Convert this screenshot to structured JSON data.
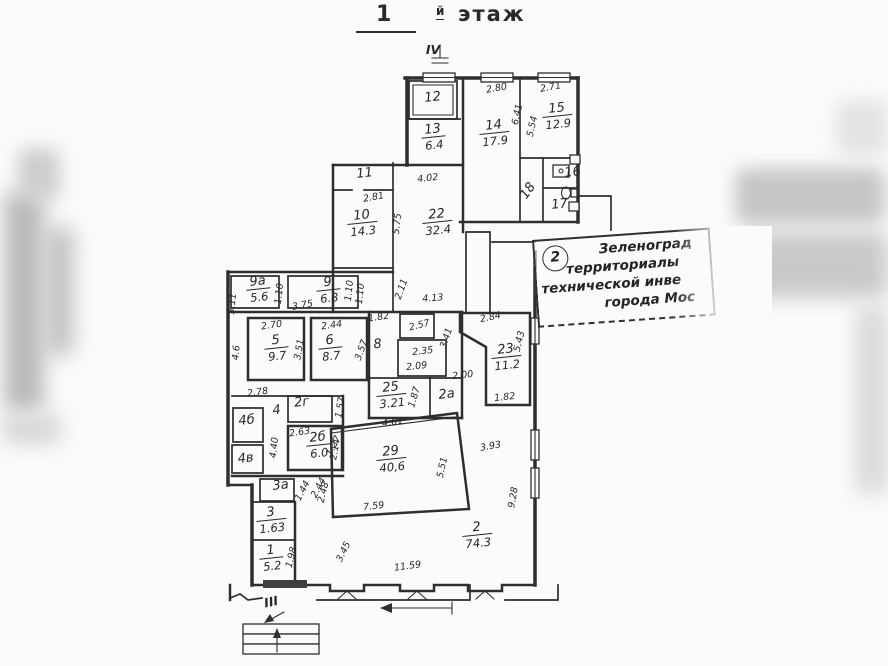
{
  "title": {
    "floor": "1",
    "suffix": "й",
    "word": "этаж"
  },
  "stamp": {
    "number": "2",
    "lines": [
      "Зеленоград",
      "территориалы",
      "технической инве",
      "города Мос"
    ]
  },
  "plan": {
    "rooms": [
      {
        "num": "12",
        "x": 433,
        "y": 101
      },
      {
        "num": "13",
        "area": "6.4",
        "x": 433,
        "y": 133
      },
      {
        "num": "14",
        "area": "17.9",
        "x": 494,
        "y": 129
      },
      {
        "num": "15",
        "area": "12.9",
        "x": 557,
        "y": 112
      },
      {
        "num": "16",
        "x": 573,
        "y": 176,
        "fs": 10
      },
      {
        "num": "17",
        "x": 560,
        "y": 208,
        "fs": 11
      },
      {
        "num": "18",
        "x": 531,
        "y": 193,
        "rot": -55,
        "fs": 11
      },
      {
        "num": "11",
        "x": 365,
        "y": 177
      },
      {
        "num": "10",
        "area": "14.3",
        "x": 362,
        "y": 219
      },
      {
        "num": "22",
        "area": "32.4",
        "x": 437,
        "y": 218
      },
      {
        "num": "9а",
        "area": "5.6",
        "x": 258,
        "y": 285
      },
      {
        "num": "9",
        "area": "6.8",
        "x": 328,
        "y": 286
      },
      {
        "num": "5",
        "area": "9.7",
        "x": 276,
        "y": 344
      },
      {
        "num": "6",
        "area": "8.7",
        "x": 330,
        "y": 344
      },
      {
        "num": "8",
        "x": 378,
        "y": 348
      },
      {
        "num": "23",
        "area": "11.2",
        "x": 506,
        "y": 353
      },
      {
        "num": "25",
        "area": "3.21",
        "x": 391,
        "y": 391
      },
      {
        "num": "2а",
        "x": 447,
        "y": 398,
        "fs": 11
      },
      {
        "num": "2г",
        "x": 302,
        "y": 406,
        "fs": 11
      },
      {
        "num": "2б",
        "area": "6.0",
        "x": 318,
        "y": 441
      },
      {
        "num": "4",
        "x": 277,
        "y": 414,
        "fs": 11
      },
      {
        "num": "4б",
        "x": 247,
        "y": 424,
        "fs": 11
      },
      {
        "num": "4в",
        "x": 246,
        "y": 462,
        "fs": 11
      },
      {
        "num": "3а",
        "x": 281,
        "y": 489,
        "fs": 11
      },
      {
        "num": "3",
        "area": "1.63",
        "x": 271,
        "y": 516
      },
      {
        "num": "1",
        "area": "5.2",
        "x": 271,
        "y": 554
      },
      {
        "num": "29",
        "area": "40,6",
        "x": 391,
        "y": 455
      },
      {
        "num": "2",
        "area": "74.3",
        "x": 477,
        "y": 531
      }
    ],
    "dimensions": [
      {
        "t": "2.80",
        "x": 497,
        "y": 91,
        "rot": -10
      },
      {
        "t": "2.71",
        "x": 551,
        "y": 90,
        "rot": -10
      },
      {
        "t": "6.41",
        "x": 520,
        "y": 115,
        "rot": -78
      },
      {
        "t": "5.54",
        "x": 535,
        "y": 127,
        "rot": -78
      },
      {
        "t": "4.02",
        "x": 428,
        "y": 181,
        "rot": -6
      },
      {
        "t": "2.81",
        "x": 374,
        "y": 200,
        "rot": -10
      },
      {
        "t": "5.75",
        "x": 400,
        "y": 224,
        "rot": -84
      },
      {
        "t": "1.10",
        "x": 352,
        "y": 291,
        "rot": -84
      },
      {
        "t": "2.11",
        "x": 404,
        "y": 290,
        "rot": -70
      },
      {
        "t": "4.13",
        "x": 433,
        "y": 301,
        "rot": -4
      },
      {
        "t": "3.11",
        "x": 235,
        "y": 304,
        "rot": -84
      },
      {
        "t": "1.10",
        "x": 282,
        "y": 294,
        "rot": -84
      },
      {
        "t": "3.75",
        "x": 303,
        "y": 308,
        "rot": -10
      },
      {
        "t": "1.10",
        "x": 363,
        "y": 294,
        "rot": -84
      },
      {
        "t": "2.70",
        "x": 272,
        "y": 328,
        "rot": -8
      },
      {
        "t": "3.51",
        "x": 302,
        "y": 350,
        "rot": -80
      },
      {
        "t": "2.44",
        "x": 332,
        "y": 328,
        "rot": -8
      },
      {
        "t": "3.57",
        "x": 364,
        "y": 351,
        "rot": -70
      },
      {
        "t": "4.6",
        "x": 239,
        "y": 353,
        "rot": -84
      },
      {
        "t": "1.82",
        "x": 379,
        "y": 320,
        "rot": -8
      },
      {
        "t": "2.57",
        "x": 420,
        "y": 328,
        "rot": -14
      },
      {
        "t": "2.35",
        "x": 423,
        "y": 354,
        "rot": -6
      },
      {
        "t": "2.09",
        "x": 417,
        "y": 369,
        "rot": -6
      },
      {
        "t": "3.41",
        "x": 449,
        "y": 339,
        "rot": -72
      },
      {
        "t": "2.84",
        "x": 491,
        "y": 320,
        "rot": -12
      },
      {
        "t": "5.43",
        "x": 522,
        "y": 342,
        "rot": -76
      },
      {
        "t": "2.00",
        "x": 463,
        "y": 378,
        "rot": -6
      },
      {
        "t": "1.82",
        "x": 505,
        "y": 400,
        "rot": -6
      },
      {
        "t": "2.78",
        "x": 258,
        "y": 395,
        "rot": -8
      },
      {
        "t": "1.57",
        "x": 343,
        "y": 408,
        "rot": -80
      },
      {
        "t": "2.63",
        "x": 300,
        "y": 435,
        "rot": -8
      },
      {
        "t": "2.14",
        "x": 338,
        "y": 450,
        "rot": -80
      },
      {
        "t": "4.40",
        "x": 277,
        "y": 448,
        "rot": -84
      },
      {
        "t": "1.87",
        "x": 417,
        "y": 398,
        "rot": -74
      },
      {
        "t": "4.61",
        "x": 393,
        "y": 425,
        "rot": -8
      },
      {
        "t": "1.27",
        "x": 336,
        "y": 447,
        "rot": -62
      },
      {
        "t": "2.48",
        "x": 326,
        "y": 493,
        "rot": -76
      },
      {
        "t": "7.59",
        "x": 374,
        "y": 509,
        "rot": -6
      },
      {
        "t": "5.51",
        "x": 445,
        "y": 468,
        "rot": -78
      },
      {
        "t": "3.93",
        "x": 491,
        "y": 449,
        "rot": -10
      },
      {
        "t": "9.28",
        "x": 516,
        "y": 498,
        "rot": -80
      },
      {
        "t": "3.45",
        "x": 346,
        "y": 553,
        "rot": -64
      },
      {
        "t": "11.59",
        "x": 408,
        "y": 569,
        "rot": -8
      },
      {
        "t": "1.98",
        "x": 294,
        "y": 558,
        "rot": -76
      },
      {
        "t": "1.44",
        "x": 305,
        "y": 492,
        "rot": -62
      },
      {
        "t": "2.44",
        "x": 321,
        "y": 489,
        "rot": -62
      }
    ],
    "stair_markers": [
      {
        "t": "IV",
        "x": 433,
        "y": 54,
        "rot": 0
      },
      {
        "t": "III",
        "x": 272,
        "y": 606,
        "rot": -12
      }
    ]
  }
}
